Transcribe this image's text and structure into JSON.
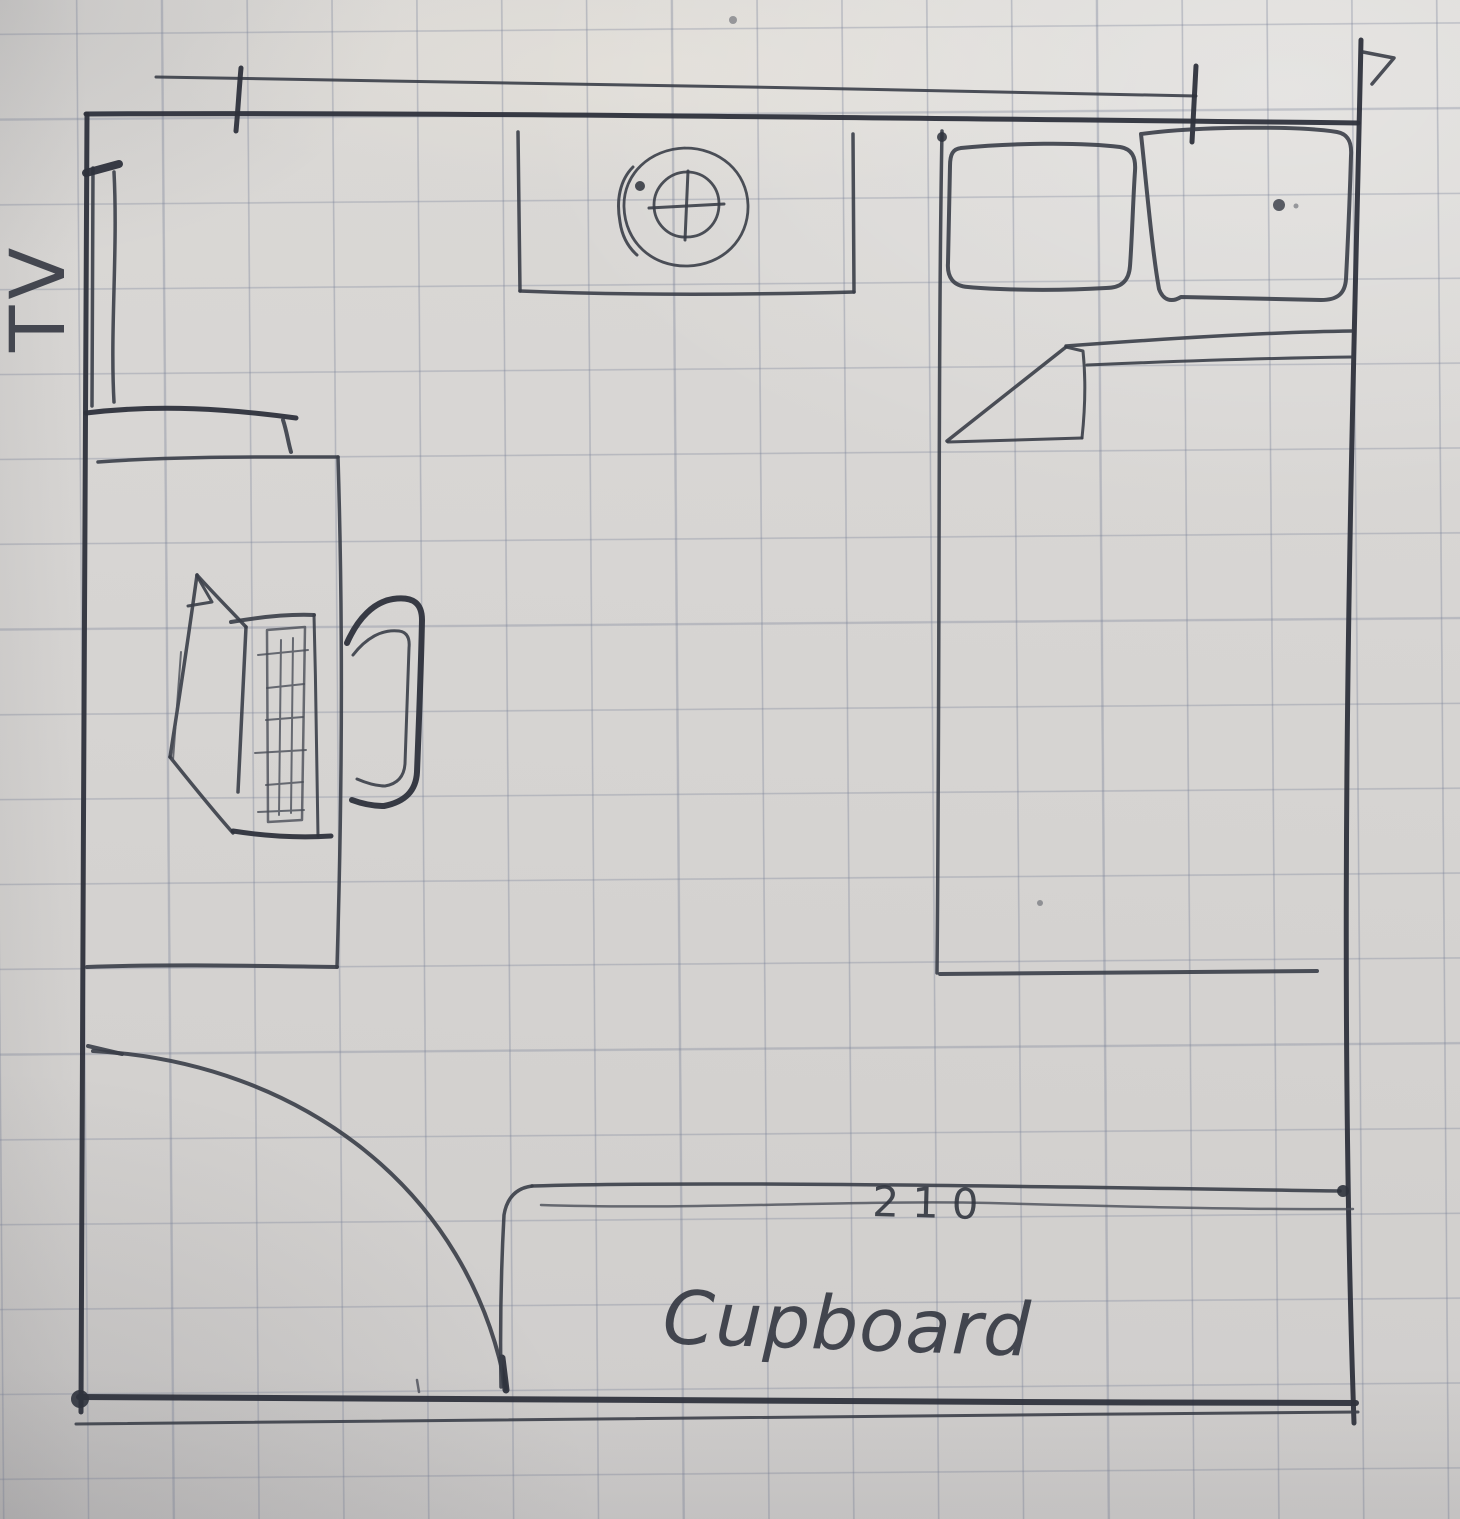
{
  "sketch": {
    "labels": {
      "tv": "TV",
      "cupboard": "Cupboard",
      "dimension": "210"
    },
    "colors": {
      "paper": "#d7d5d3",
      "grid_line": "#7a82a0",
      "ink": "#363a44"
    },
    "elements": {
      "room": "room outline",
      "tv_unit": "TV on left wall",
      "shelf": "TV stand shelf",
      "desk": "desk",
      "laptop": "open laptop on desk",
      "chair": "desk chair",
      "fan_window": "window box with fan symbol",
      "bed": "bed",
      "pillows": "two pillows",
      "blanket_fold": "folded blanket corner",
      "door": "door swing arc",
      "cupboard": "cupboard along bottom wall",
      "dimension_line": "dimension line across top"
    }
  }
}
